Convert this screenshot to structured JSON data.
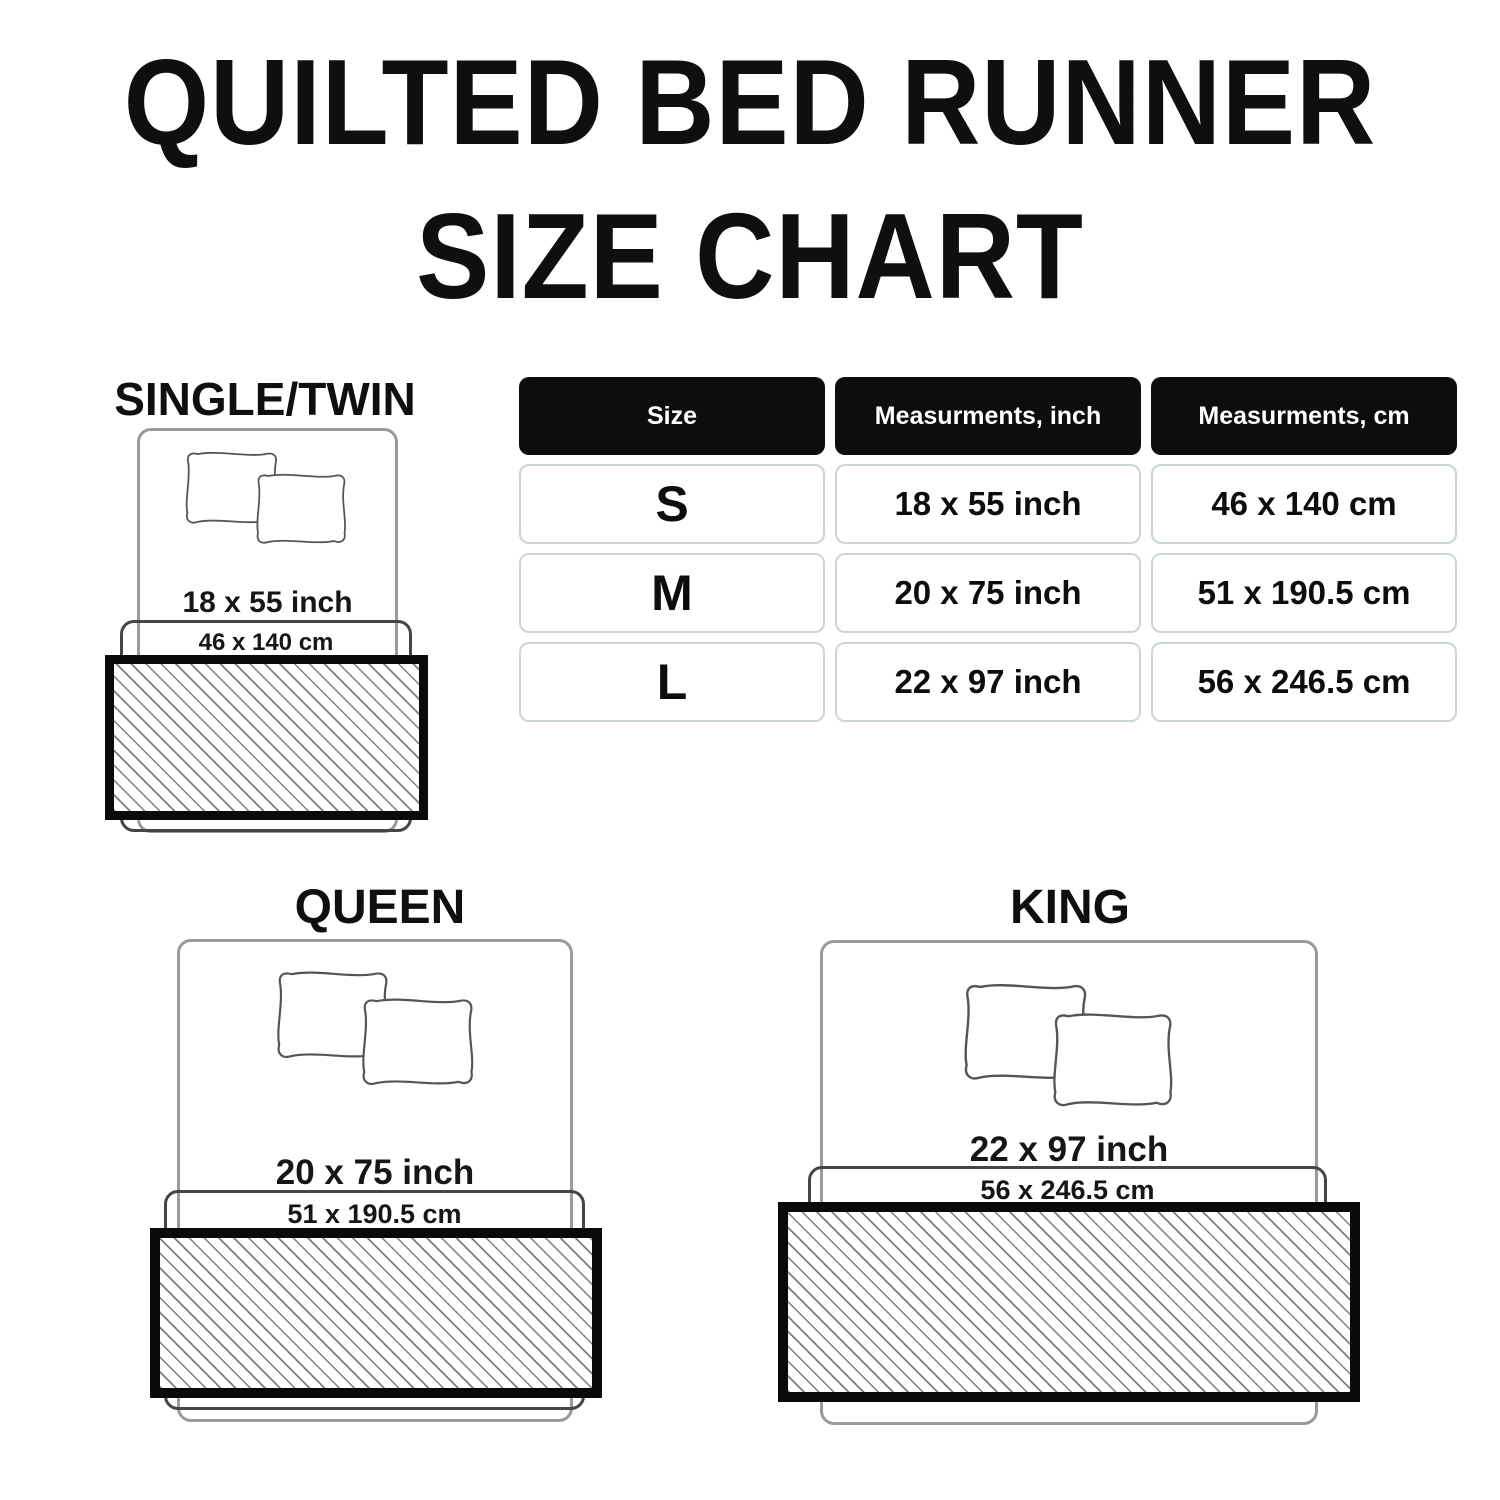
{
  "title": {
    "line1": "QUILTED BED RUNNER",
    "line2": "SIZE CHART"
  },
  "table": {
    "headers": [
      "Size",
      "Measurments, inch",
      "Measurments, cm"
    ],
    "rows": [
      {
        "size": "S",
        "inch": "18 x 55 inch",
        "cm": "46 x 140 cm"
      },
      {
        "size": "M",
        "inch": "20 x 75 inch",
        "cm": "51 x 190.5 cm"
      },
      {
        "size": "L",
        "inch": "22 x 97 inch",
        "cm": "56 x 246.5 cm"
      }
    ]
  },
  "diagrams": [
    {
      "name": "SINGLE/TWIN",
      "inch": "18 x 55 inch",
      "cm": "46 x 140 cm"
    },
    {
      "name": "QUEEN",
      "inch": "20 x 75 inch",
      "cm": "51 x 190.5 cm"
    },
    {
      "name": "KING",
      "inch": "22 x 97 inch",
      "cm": "56 x 246.5 cm"
    }
  ],
  "colors": {
    "background": "#ffffff",
    "text": "#111111",
    "header_cell_bg": "#0d0d0d",
    "header_cell_text": "#ffffff",
    "data_cell_border": "#ccd5da",
    "bed_outline": "#9a9a9a",
    "pillow_outline": "#555555",
    "runner_cm_outline": "#454545",
    "runner_border": "#0a0a0a",
    "hatch_line": "#7d7d7d"
  }
}
